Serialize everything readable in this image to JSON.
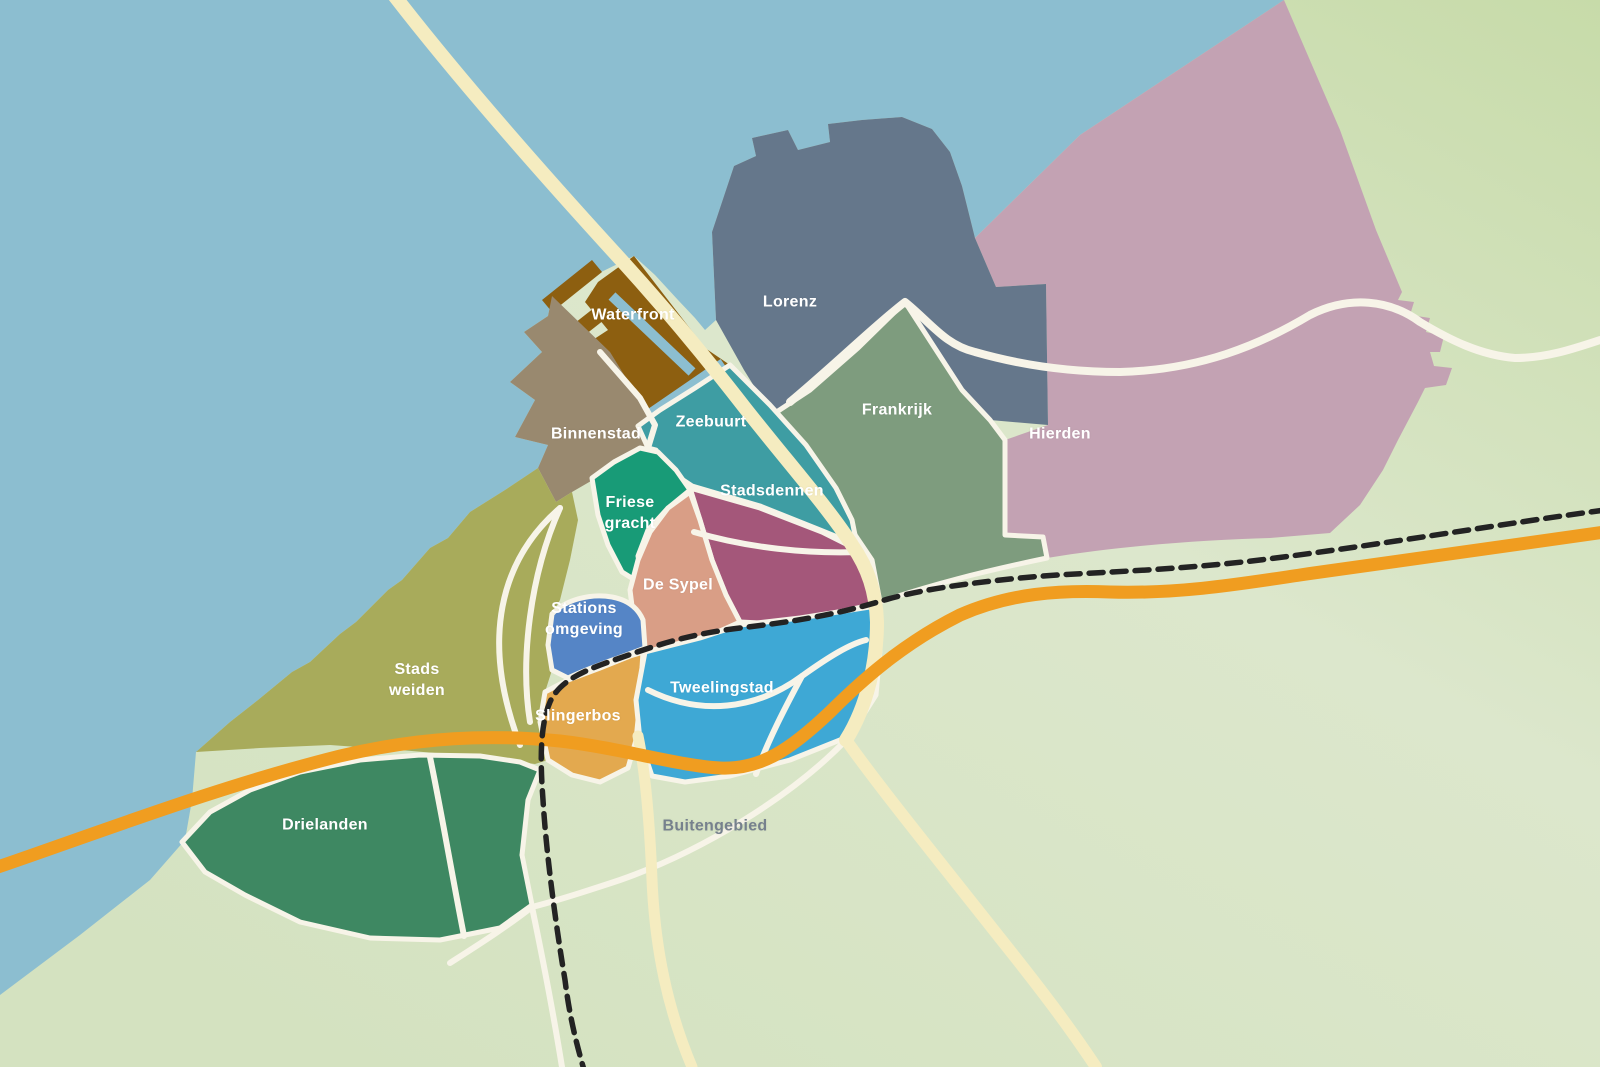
{
  "map": {
    "background": {
      "water_color": "#8CBED0",
      "land_color_top_right": "#C7DBA9",
      "land_color_mid": "#DCE7CC",
      "land_color_bottom": "#D4E2C0"
    },
    "roads": {
      "main_road_color": "#F5ECC0",
      "local_road_color": "#F7F4E8",
      "highway_color": "#F09D20",
      "railway_color": "#232323"
    },
    "districts": [
      {
        "id": "hierden",
        "label": "Hierden",
        "color": "#C3A2B3",
        "label_color": "#FFFFFF",
        "label_x": 1060,
        "label_y": 435
      },
      {
        "id": "lorenz",
        "label": "Lorenz",
        "color": "#65778B",
        "label_color": "#FFFFFF",
        "label_x": 790,
        "label_y": 303
      },
      {
        "id": "frankrijk",
        "label": "Frankrijk",
        "color": "#7E9C7E",
        "label_color": "#FFFFFF",
        "label_x": 897,
        "label_y": 411
      },
      {
        "id": "waterfront",
        "label": "Waterfront",
        "color": "#8D5F10",
        "label_color": "#FFFFFF",
        "label_x": 633,
        "label_y": 316
      },
      {
        "id": "binnenstad",
        "label": "Binnenstad",
        "color": "#99896F",
        "label_color": "#FFFFFF",
        "label_x": 596,
        "label_y": 435
      },
      {
        "id": "zeebuurt",
        "label": "Zeebuurt",
        "color": "#3E9DA3",
        "label_color": "#FFFFFF",
        "label_x": 711,
        "label_y": 423
      },
      {
        "id": "friese-gracht",
        "label": "Friese\ngracht",
        "color": "#189B77",
        "label_color": "#FFFFFF",
        "label_x": 630,
        "label_y": 514
      },
      {
        "id": "stadsdennen",
        "label": "Stadsdennen",
        "color": "#A4577A",
        "label_color": "#FFFFFF",
        "label_x": 772,
        "label_y": 492
      },
      {
        "id": "de-sypel",
        "label": "De Sypel",
        "color": "#D99E86",
        "label_color": "#FFFFFF",
        "label_x": 678,
        "label_y": 586
      },
      {
        "id": "stations-omgeving",
        "label": "Stations\nomgeving",
        "color": "#5585C6",
        "label_color": "#FFFFFF",
        "label_x": 584,
        "label_y": 620
      },
      {
        "id": "stads-weiden",
        "label": "Stads\nweiden",
        "color": "#A8AB5B",
        "label_color": "#FFFFFF",
        "label_x": 417,
        "label_y": 681
      },
      {
        "id": "slingerbos",
        "label": "Slingerbos",
        "color": "#E3A94F",
        "label_color": "#FFFFFF",
        "label_x": 578,
        "label_y": 717
      },
      {
        "id": "tweelingstad",
        "label": "Tweelingstad",
        "color": "#3EA8D5",
        "label_color": "#FFFFFF",
        "label_x": 722,
        "label_y": 689
      },
      {
        "id": "drielanden",
        "label": "Drielanden",
        "color": "#3E8862",
        "label_color": "#FFFFFF",
        "label_x": 325,
        "label_y": 826
      },
      {
        "id": "buitengebied",
        "label": "Buitengebied",
        "color": "",
        "label_color": "#76818D",
        "label_x": 715,
        "label_y": 827
      }
    ]
  }
}
